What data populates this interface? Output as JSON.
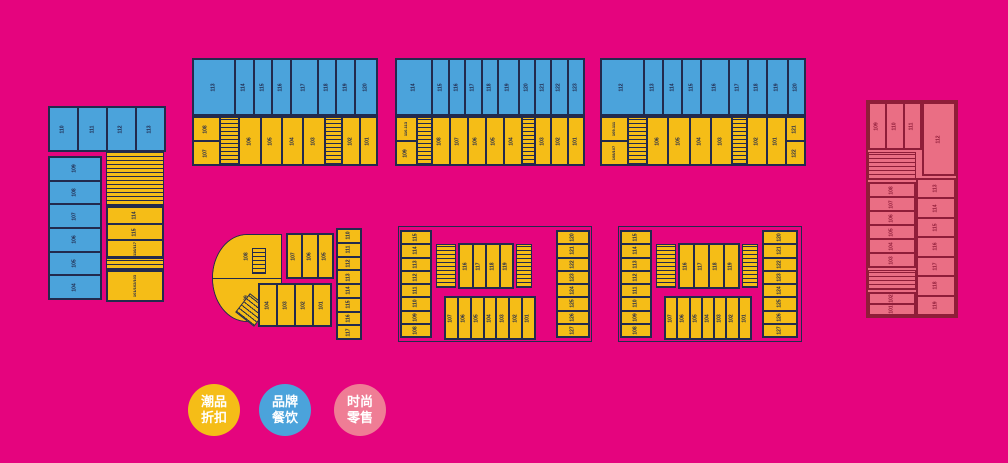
{
  "colors": {
    "background": "#E5047E",
    "discount_yellow": "#F5BD17",
    "dining_blue": "#4BA3DB",
    "retail_pink": "#EA6E84",
    "retail_pink_legend": "#EF7D95",
    "wall_dark": "#222A4D",
    "wall_maroon": "#8F1D39",
    "legend_text": "#FFFFFF"
  },
  "legend": {
    "items": [
      {
        "line1": "潮品",
        "line2": "折扣",
        "color_key": "discount_yellow"
      },
      {
        "line1": "品牌",
        "line2": "餐饮",
        "color_key": "dining_blue"
      },
      {
        "line1": "时尚",
        "line2": "零售",
        "color_key": "retail_pink_legend"
      }
    ]
  },
  "blocks": {
    "left_block": {
      "top_row": [
        "110",
        "111",
        "112",
        "113"
      ],
      "left_col": [
        "109",
        "108",
        "107",
        "106",
        "105",
        "104"
      ],
      "right_upper": [
        "114",
        "115",
        "116/117"
      ],
      "right_lower": [
        "101/102/103"
      ]
    },
    "top1": {
      "blue": [
        "113",
        "114",
        "115",
        "116",
        "117",
        "118",
        "119",
        "120"
      ],
      "yellow": [
        "108",
        "107",
        "106",
        "105",
        "104",
        "103",
        "102",
        "101"
      ]
    },
    "top2": {
      "blue": [
        "114",
        "115",
        "116",
        "117",
        "118",
        "119",
        "120",
        "121",
        "122",
        "123"
      ],
      "yellow": [
        "110-113",
        "109",
        "108",
        "107",
        "106",
        "105",
        "104",
        "103",
        "102",
        "101"
      ]
    },
    "top3": {
      "blue": [
        "112",
        "113",
        "114",
        "115",
        "116",
        "117",
        "118",
        "119",
        "120"
      ],
      "yellow": [
        "109-111",
        "108/107",
        "106",
        "105",
        "104",
        "103",
        "102",
        "101",
        "121",
        "122"
      ]
    },
    "right_block": {
      "top_row": [
        "109",
        "110",
        "111"
      ],
      "big": [
        "112"
      ],
      "right_col": [
        "113",
        "114",
        "115",
        "116",
        "117",
        "118",
        "119"
      ],
      "left_col_upper": [
        "108",
        "107",
        "106",
        "105",
        "104",
        "103"
      ],
      "left_col_lower": [
        "102",
        "101"
      ]
    },
    "bottom1": {
      "fan": [
        "108",
        "109"
      ],
      "top_row": [
        "107",
        "106",
        "105"
      ],
      "mid_row": [
        "104",
        "103",
        "102",
        "101"
      ],
      "right_strip": [
        "110",
        "111",
        "112",
        "113",
        "114",
        "115",
        "116",
        "117"
      ]
    },
    "bottom2": {
      "left_strip": [
        "115",
        "114",
        "113",
        "112",
        "111",
        "110",
        "109",
        "108"
      ],
      "mid_top": [
        "116",
        "117",
        "118",
        "119"
      ],
      "mid_bottom": [
        "107",
        "106",
        "105",
        "104",
        "103",
        "102",
        "101"
      ],
      "right_strip": [
        "120",
        "121",
        "122",
        "123",
        "124",
        "125",
        "126",
        "127"
      ]
    },
    "bottom3": {
      "left_strip": [
        "115",
        "114",
        "113",
        "112",
        "111",
        "110",
        "109",
        "108"
      ],
      "mid_top": [
        "116",
        "117",
        "118",
        "119"
      ],
      "mid_bottom": [
        "107",
        "106",
        "105",
        "104",
        "103",
        "102",
        "101"
      ],
      "right_strip": [
        "120",
        "121",
        "122",
        "123",
        "124",
        "125",
        "126",
        "127"
      ]
    }
  }
}
